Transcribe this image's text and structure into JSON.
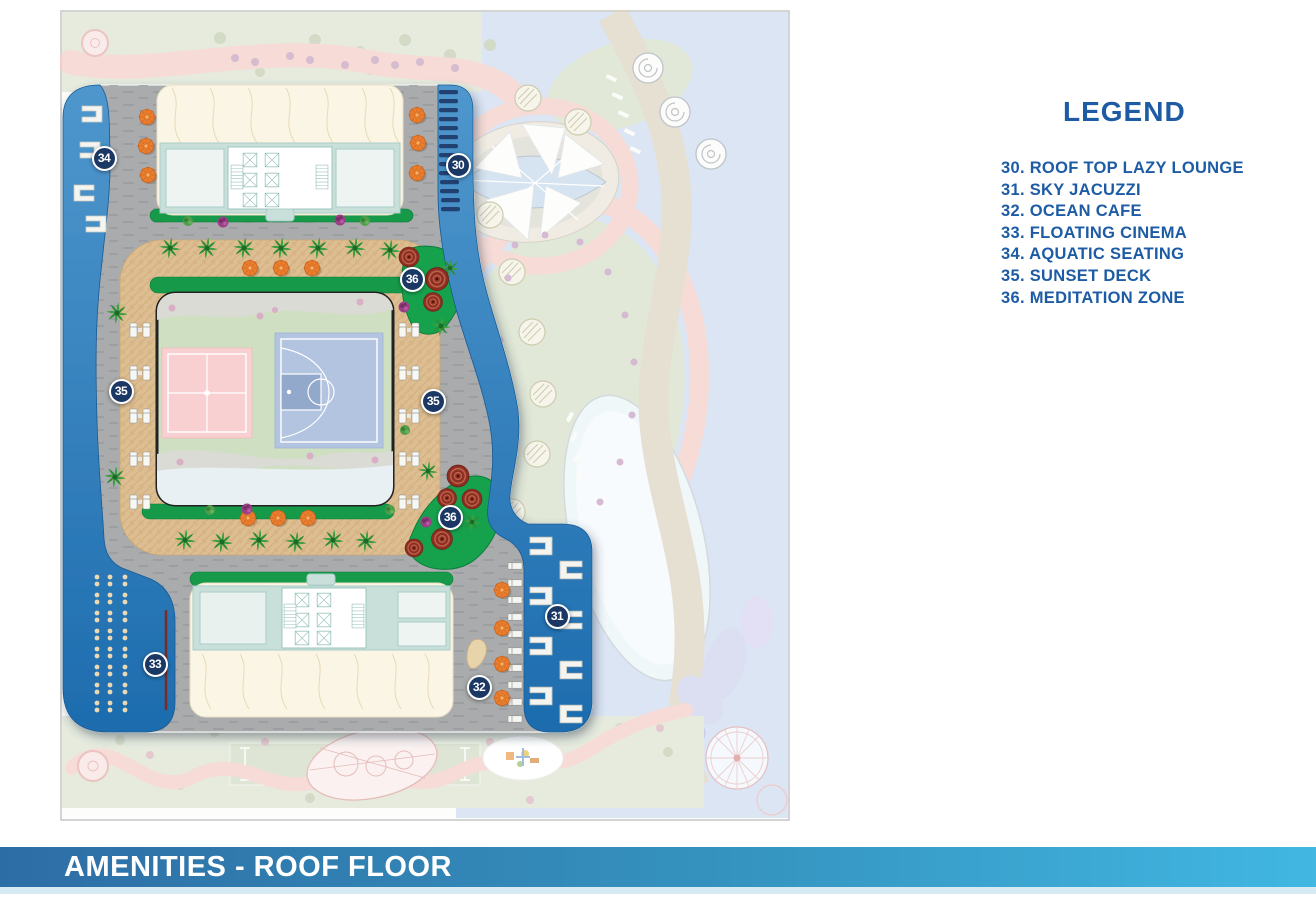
{
  "legend": {
    "title": "LEGEND",
    "items": [
      "30. ROOF TOP LAZY LOUNGE",
      "31. SKY JACUZZI",
      "32. OCEAN CAFE",
      "33. FLOATING CINEMA",
      "34. AQUATIC SEATING",
      "35. SUNSET DECK",
      "36. MEDITATION ZONE"
    ]
  },
  "footer": {
    "title": "AMENITIES - ROOF FLOOR"
  },
  "markers": [
    {
      "num": "34"
    },
    {
      "num": "30"
    },
    {
      "num": "36"
    },
    {
      "num": "35"
    },
    {
      "num": "35"
    },
    {
      "num": "36"
    },
    {
      "num": "31"
    },
    {
      "num": "33"
    },
    {
      "num": "32"
    }
  ],
  "colors": {
    "legend_text": "#1d5ca4",
    "banner_gradient_start": "#2d6da5",
    "banner_gradient_end": "#41b7e2",
    "marker_bg": "#1b3764",
    "water": "#2a7fc0",
    "deck_gray": "#a9abad",
    "track_tan": "#ddbe92",
    "hedge_green": "#129a48",
    "umbrella_orange": "#ea7e2f"
  }
}
